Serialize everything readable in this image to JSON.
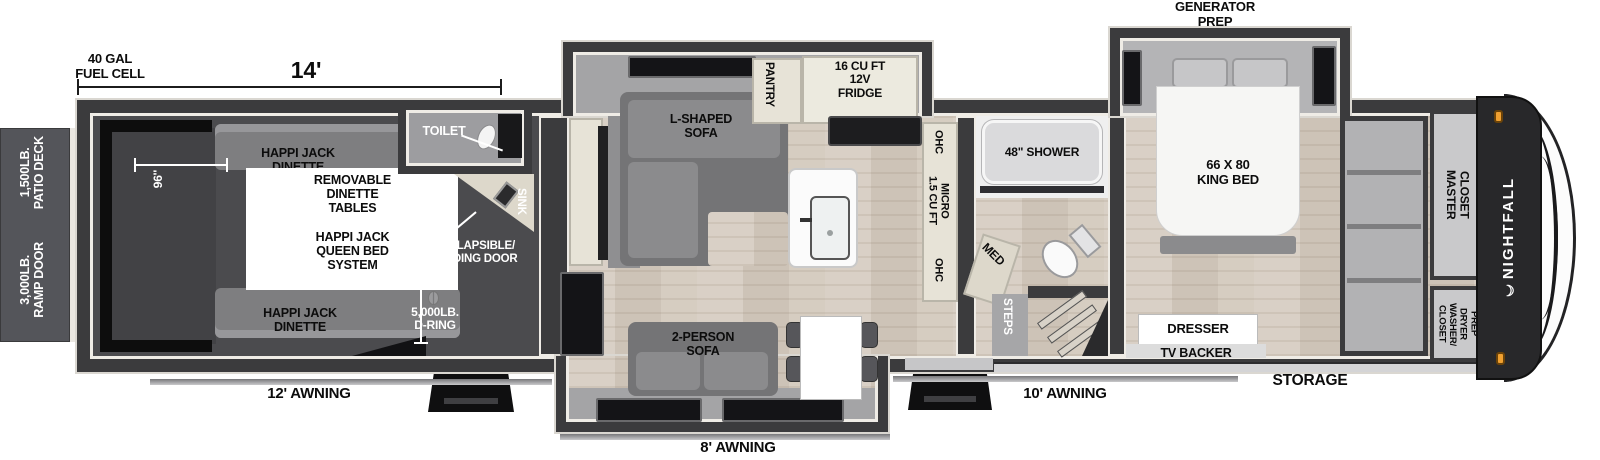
{
  "exterior": {
    "fuel_cell": "40 GAL\nFUEL CELL",
    "length": "14'",
    "patio_deck": "1,500LB.\nPATIO DECK",
    "ramp_door": "3,000LB.\nRAMP DOOR",
    "awning_garage": "12' AWNING",
    "awning_living": "8' AWNING",
    "awning_main": "10' AWNING",
    "storage": "STORAGE",
    "generator_prep": "GENERATOR\nPREP"
  },
  "garage": {
    "width": "96''",
    "height": "75\"",
    "dinette_top": "HAPPI JACK\nDINETTE",
    "dinette_bottom": "HAPPI JACK\nDINETTE",
    "removable_tables": "REMOVABLE\nDINETTE\nTABLES",
    "queen_bed": "HAPPI JACK\nQUEEN BED\nSYSTEM",
    "d_ring": "5,000LB.\nD-RING",
    "folding_door": "COLLAPSIBLE/\nFOLDING DOOR",
    "toilet": "TOILET",
    "sink": "SINK"
  },
  "living": {
    "ent_center": "ENT. CENTER\nW/ FIREPLACE",
    "l_sofa": "L-SHAPED\nSOFA",
    "pantry": "PANTRY",
    "fridge": "16 CU FT\n12V\nFRIDGE",
    "ohc_top": "OHC",
    "micro": "1.5 CU FT\nMICRO",
    "ohc_bottom": "OHC",
    "sofa": "2-PERSON\nSOFA"
  },
  "bath": {
    "shower": "48\" SHOWER",
    "med": "MED",
    "steps": "STEPS"
  },
  "bedroom": {
    "king_bed": "66 X 80\nKING BED",
    "dresser": "DRESSER",
    "tv_backer": "TV BACKER",
    "master_closet": "MASTER\nCLOSET",
    "washer_dryer": "CLOSET\nWASHER/\nDRYER\nPREP"
  },
  "brand": {
    "moon": "☾",
    "name": "NIGHTFALL"
  },
  "colors": {
    "wall": "#3b3b3d",
    "floor": "#d7cec4",
    "slide": "#a4a4a6",
    "garage_interior": "#4b4b4e",
    "cabinet": "#e7e3d7",
    "flame": "#e8931c",
    "marker_light": "#f0a030"
  }
}
